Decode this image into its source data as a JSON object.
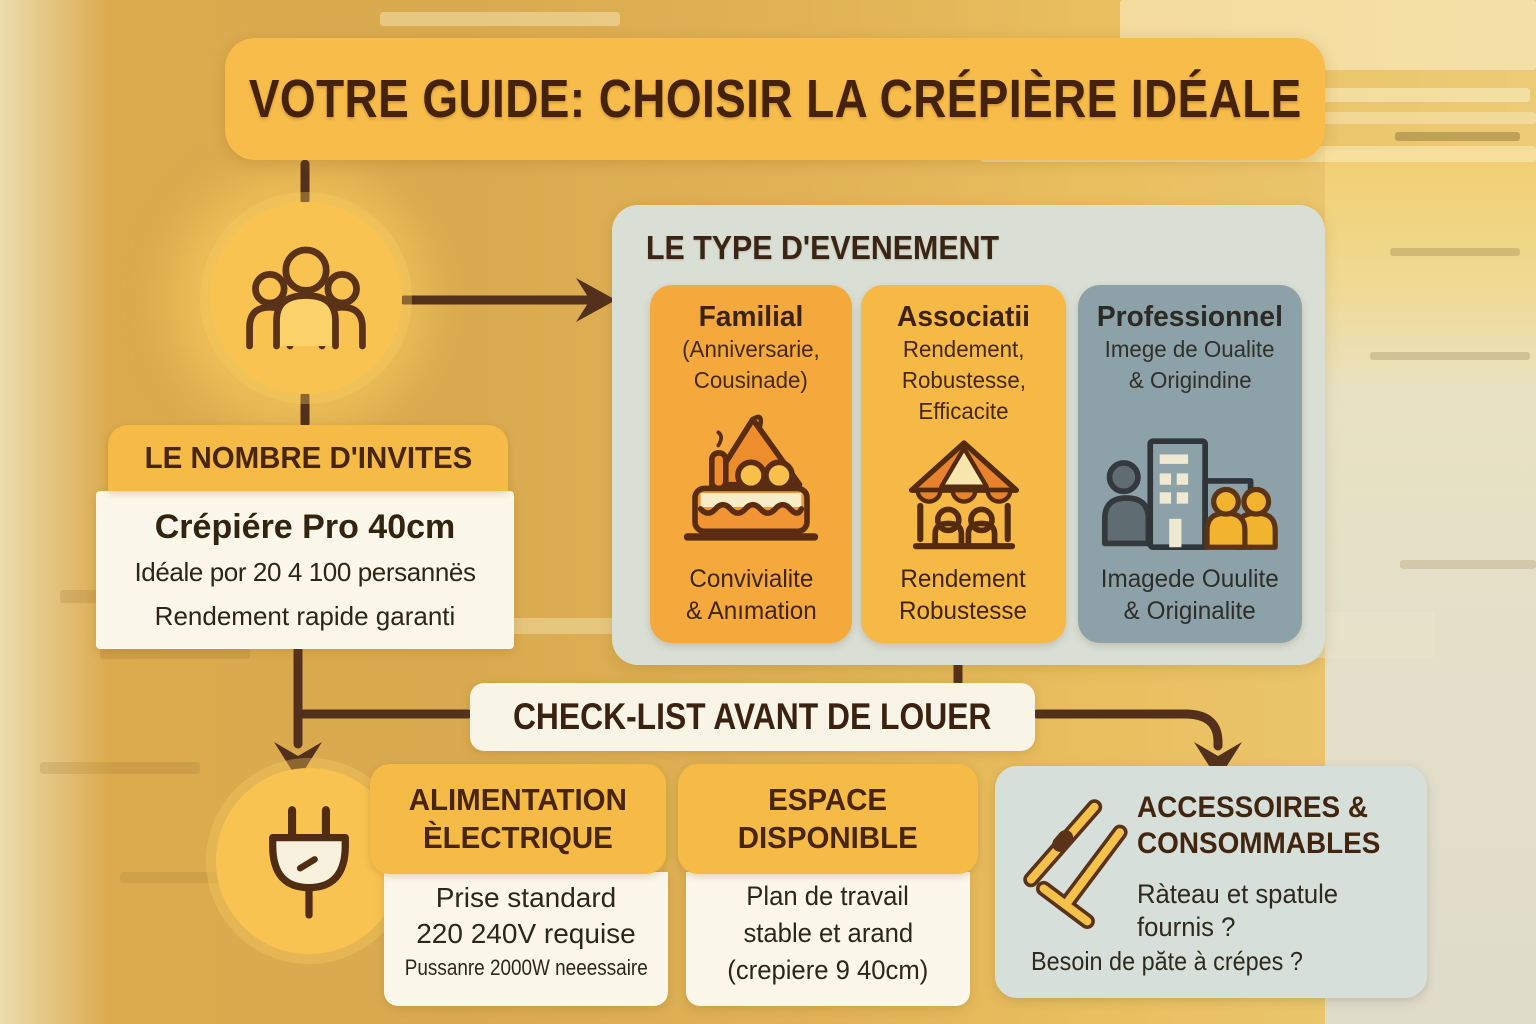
{
  "title": "VOTRE GUIDE: CHOISIR LA CRÉPIÈRE IDÉALE",
  "guests_section": {
    "icon": "people-icon",
    "header": "LE NOMBRE D'INVITES",
    "product": "Crépiére Pro 40cm",
    "capacity": "Idéale por 20 4 100 persannës",
    "note": "Rendement rapide garanti"
  },
  "event_types": {
    "header": "LE TYPE D'EVENEMENT",
    "cards": [
      {
        "title": "Familial",
        "sub1": "(Anniversarie,",
        "sub2": "Cousinade)",
        "foot1": "Convivialite",
        "foot2": "& Anımation",
        "icon": "birthday-cake-icon",
        "color": "#F5A93C"
      },
      {
        "title": "Associatii",
        "sub1": "Rendement,",
        "sub2": "Robustesse,",
        "sub3": "Efficacite",
        "foot1": "Rendement",
        "foot2": "Robustesse",
        "icon": "market-stall-icon",
        "color": "#F7B946"
      },
      {
        "title": "Professionnel",
        "sub1": "Imege de Oualite",
        "sub2": "& Origindine",
        "foot1": "Imagede Ouulite",
        "foot2": "& Originalite",
        "icon": "office-building-icon",
        "color": "#8CA1A8"
      }
    ]
  },
  "checklist": {
    "banner": "CHECK-LIST AVANT DE LOUER"
  },
  "power": {
    "icon": "power-plug-icon",
    "header_line1": "ALIMENTATION",
    "header_line2": "ÈLECTRIQUE",
    "line1": "Prise standard",
    "line2": "220 240V requise",
    "line3": "Pussanre 2000W neeessaire"
  },
  "space": {
    "header_line1": "ESPACE",
    "header_line2": "DISPONIBLE",
    "line1": "Plan de travail",
    "line2": "stable et arand",
    "line3": "(crepiere 9 40cm)"
  },
  "accessories": {
    "icon": "crepe-rake-and-spatula-icon",
    "header_line1": "ACCESSOIRES &",
    "header_line2": "CONSOMMABLES",
    "line1": "Ràteau et spatule",
    "line2": "fournis ?",
    "line3": "Besoin de păte à crépes ?"
  },
  "palette": {
    "background_gold": "#DCAE52",
    "title_amber": "#F7BC49",
    "dark_brown_text": "#45220C",
    "connector_brown": "#53301B",
    "card_orange": "#F5A93C",
    "card_amber": "#F7B946",
    "card_bluegrey": "#8CA1A8",
    "panel_sage": "#DADFD5",
    "cream_box": "#FBF7EA",
    "banner_cream": "#F8F4E6",
    "accessories_panel": "#D7DFDA",
    "icon_circle_yellow": "#F9C351"
  }
}
